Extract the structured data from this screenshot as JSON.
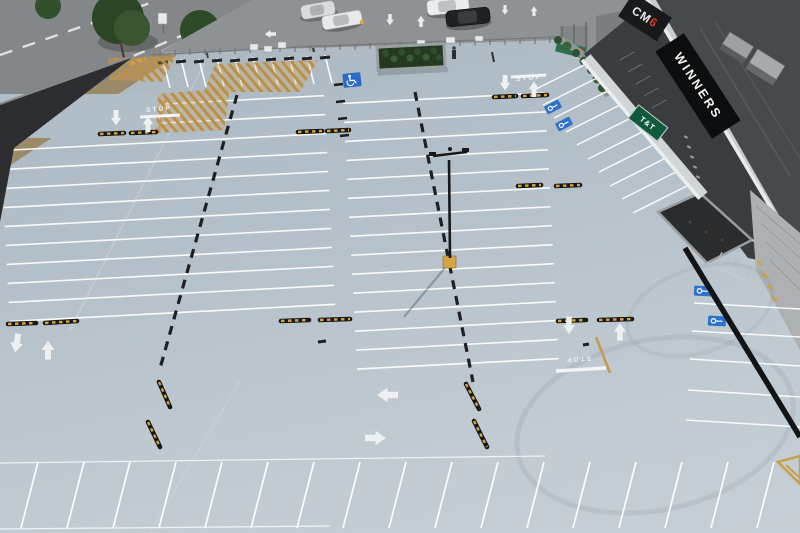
{
  "scene": {
    "title": "Aerial view of rooftop parking deck",
    "description": "Drone photo of an empty light-blue rooftop parking deck beside a shopping centre, with street and lower parking lot at top"
  },
  "signs": {
    "winners": "WINNERS",
    "mall_logo_white": "CM",
    "mall_logo_red": "6",
    "tnt": "T&T",
    "stop_entrance": "STOP",
    "stop_left": "STOP",
    "stop_right": "STOP"
  },
  "colors": {
    "deck": "#b6c2cb",
    "street_asphalt": "#84878a",
    "lot_asphalt": "#8f9294",
    "stall_line": "#ffffff",
    "divider_black": "#1e2022",
    "speed_bump_black": "#161719",
    "speed_bump_yellow": "#d9a33c",
    "hatch_tan": "#bd8f45",
    "ev_blue": "#2f72cc",
    "accessible_blue": "#2e6bc6",
    "curb_black": "#131415",
    "winners_bg": "#0c0d0e",
    "tnt_green": "#0f5a3a",
    "pole_base_yellow": "#d3a545",
    "roof_dark": "#47494b",
    "tree_green": "#2c4526"
  }
}
